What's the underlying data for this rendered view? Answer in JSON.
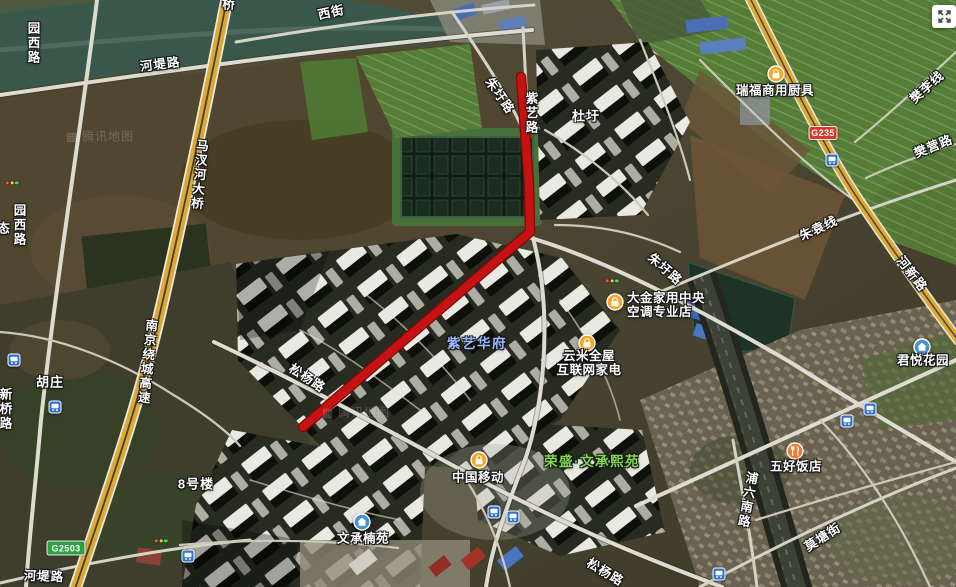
{
  "map": {
    "watermark": {
      "logo": "▦",
      "text": "腾讯地图"
    },
    "watermark_positions": [
      {
        "x": 100,
        "y": 136
      },
      {
        "x": 356,
        "y": 412
      }
    ],
    "route": {
      "color": "#c51313",
      "casing": "#7e0909",
      "width": 8,
      "points": [
        [
          521,
          77
        ],
        [
          529,
          185
        ],
        [
          530,
          232
        ],
        [
          303,
          427
        ]
      ]
    },
    "road_labels": [
      {
        "id": "xijie",
        "text": "西街",
        "x": 331,
        "y": 11,
        "rot": -12
      },
      {
        "id": "hetilu-top",
        "text": "河堤路",
        "x": 160,
        "y": 63,
        "rot": -7
      },
      {
        "id": "yuanxilu-top",
        "text": "园西路",
        "x": 33,
        "y": 43,
        "vertical": true
      },
      {
        "id": "qiao-partial",
        "text": "桥",
        "x": 229,
        "y": 3
      },
      {
        "id": "machahe-daqiao",
        "text": "马汊河大桥",
        "x": 199,
        "y": 175,
        "vertical": true,
        "rot": 5
      },
      {
        "id": "yuanxilu-mid",
        "text": "园西路",
        "x": 19,
        "y": 225,
        "vertical": true
      },
      {
        "id": "tai-partial",
        "text": "态",
        "x": 4,
        "y": 227
      },
      {
        "id": "nanjing-raocheng-gaosu",
        "text": "南京绕城高速",
        "x": 147,
        "y": 362,
        "vertical": true,
        "rot": 6
      },
      {
        "id": "huzhuang",
        "text": "胡庄",
        "x": 50,
        "y": 381,
        "kind": "village"
      },
      {
        "id": "xinqiaolu",
        "text": "新桥路",
        "x": 5,
        "y": 409,
        "vertical": true
      },
      {
        "id": "hetilu-bottom",
        "text": "河堤路",
        "x": 44,
        "y": 575,
        "rot": 2
      },
      {
        "id": "songyanglu-w",
        "text": "松杨路",
        "x": 308,
        "y": 377,
        "rot": 33
      },
      {
        "id": "songyanglu-s",
        "text": "松杨路",
        "x": 606,
        "y": 571,
        "rot": 31
      },
      {
        "id": "zhuweilu-n",
        "text": "朱圩路",
        "x": 501,
        "y": 95,
        "rot": 55
      },
      {
        "id": "ziyilu",
        "text": "紫艺路",
        "x": 531,
        "y": 113,
        "vertical": true
      },
      {
        "id": "duwei",
        "text": "杜圩",
        "x": 586,
        "y": 115,
        "kind": "village"
      },
      {
        "id": "zhuweilu-e",
        "text": "朱圩路",
        "x": 666,
        "y": 268,
        "rot": 41
      },
      {
        "id": "zhuyuanxian",
        "text": "朱袁线",
        "x": 818,
        "y": 227,
        "rot": -25
      },
      {
        "id": "fanlixian",
        "text": "樊李线",
        "x": 926,
        "y": 86,
        "rot": -42
      },
      {
        "id": "fanyinglu",
        "text": "樊营路",
        "x": 933,
        "y": 145,
        "rot": -22
      },
      {
        "id": "hexinlu",
        "text": "河新路",
        "x": 913,
        "y": 273,
        "rot": 52
      },
      {
        "id": "puliunanlu",
        "text": "浦六南路",
        "x": 747,
        "y": 500,
        "vertical": true,
        "rot": 10
      },
      {
        "id": "motangjie",
        "text": "莫塘街",
        "x": 822,
        "y": 536,
        "rot": -33
      },
      {
        "id": "bahaolou",
        "text": "8号楼",
        "x": 196,
        "y": 483,
        "kind": "building"
      }
    ],
    "area_labels": [
      {
        "id": "ziyi-huafu",
        "text": "紫艺华府",
        "x": 477,
        "y": 342,
        "color": "#9cb9ff"
      },
      {
        "id": "rongsheng-wencheng-xiyuan",
        "text": "荣盛·文承熙苑",
        "x": 592,
        "y": 460,
        "color": "#83d84f"
      }
    ],
    "pois": [
      {
        "id": "ruifu-shangyong-chuju",
        "icon": "bag",
        "ix": 776,
        "iy": 74,
        "lines": [
          "瑞福商用厨具"
        ],
        "tx": 775,
        "ty": 91,
        "anchor": "center"
      },
      {
        "id": "dajin-zhongyang-kongtiao",
        "icon": "bag",
        "ix": 615,
        "iy": 302,
        "lines": [
          "大金家用中央",
          "空调专业店"
        ],
        "tx": 627,
        "ty": 292,
        "anchor": "left"
      },
      {
        "id": "yunmi-hulianwang-jiadian",
        "icon": "bag",
        "ix": 587,
        "iy": 343,
        "lines": [
          "云米全屋",
          "互联网家电"
        ],
        "tx": 589,
        "ty": 350,
        "anchor": "center-top"
      },
      {
        "id": "zhongguo-yidong",
        "icon": "bag",
        "ix": 479,
        "iy": 460,
        "lines": [
          "中国移动"
        ],
        "tx": 478,
        "ty": 478,
        "anchor": "center"
      },
      {
        "id": "wencheng-nanyuan",
        "icon": "house",
        "ix": 362,
        "iy": 522,
        "lines": [
          "文承楠苑"
        ],
        "tx": 363,
        "ty": 539,
        "anchor": "center"
      },
      {
        "id": "junyue-huayuan",
        "icon": "house",
        "ix": 922,
        "iy": 347,
        "lines": [
          "君悦花园"
        ],
        "tx": 923,
        "ty": 361,
        "anchor": "center"
      },
      {
        "id": "wuhao-fandian",
        "icon": "restaurant",
        "ix": 795,
        "iy": 451,
        "lines": [
          "五好饭店"
        ],
        "tx": 796,
        "ty": 467,
        "anchor": "center"
      }
    ],
    "shields": [
      {
        "text": "G235",
        "bg": "#d6392c",
        "x": 823,
        "y": 133,
        "w": 27,
        "h": 12
      },
      {
        "text": "G2503",
        "bg": "#2f9e44",
        "x": 66,
        "y": 548,
        "w": 37,
        "h": 13
      }
    ],
    "bus_stops": [
      [
        14,
        360
      ],
      [
        55,
        407
      ],
      [
        188,
        556
      ],
      [
        494,
        512
      ],
      [
        513,
        517
      ],
      [
        832,
        160
      ],
      [
        847,
        421
      ],
      [
        870,
        409
      ],
      [
        719,
        574
      ]
    ],
    "traffic_dots": [
      [
        612,
        281
      ],
      [
        161,
        541
      ],
      [
        12,
        183
      ]
    ],
    "fullscreen": {
      "x": 932,
      "y": 5,
      "w": 24,
      "h": 23
    }
  }
}
